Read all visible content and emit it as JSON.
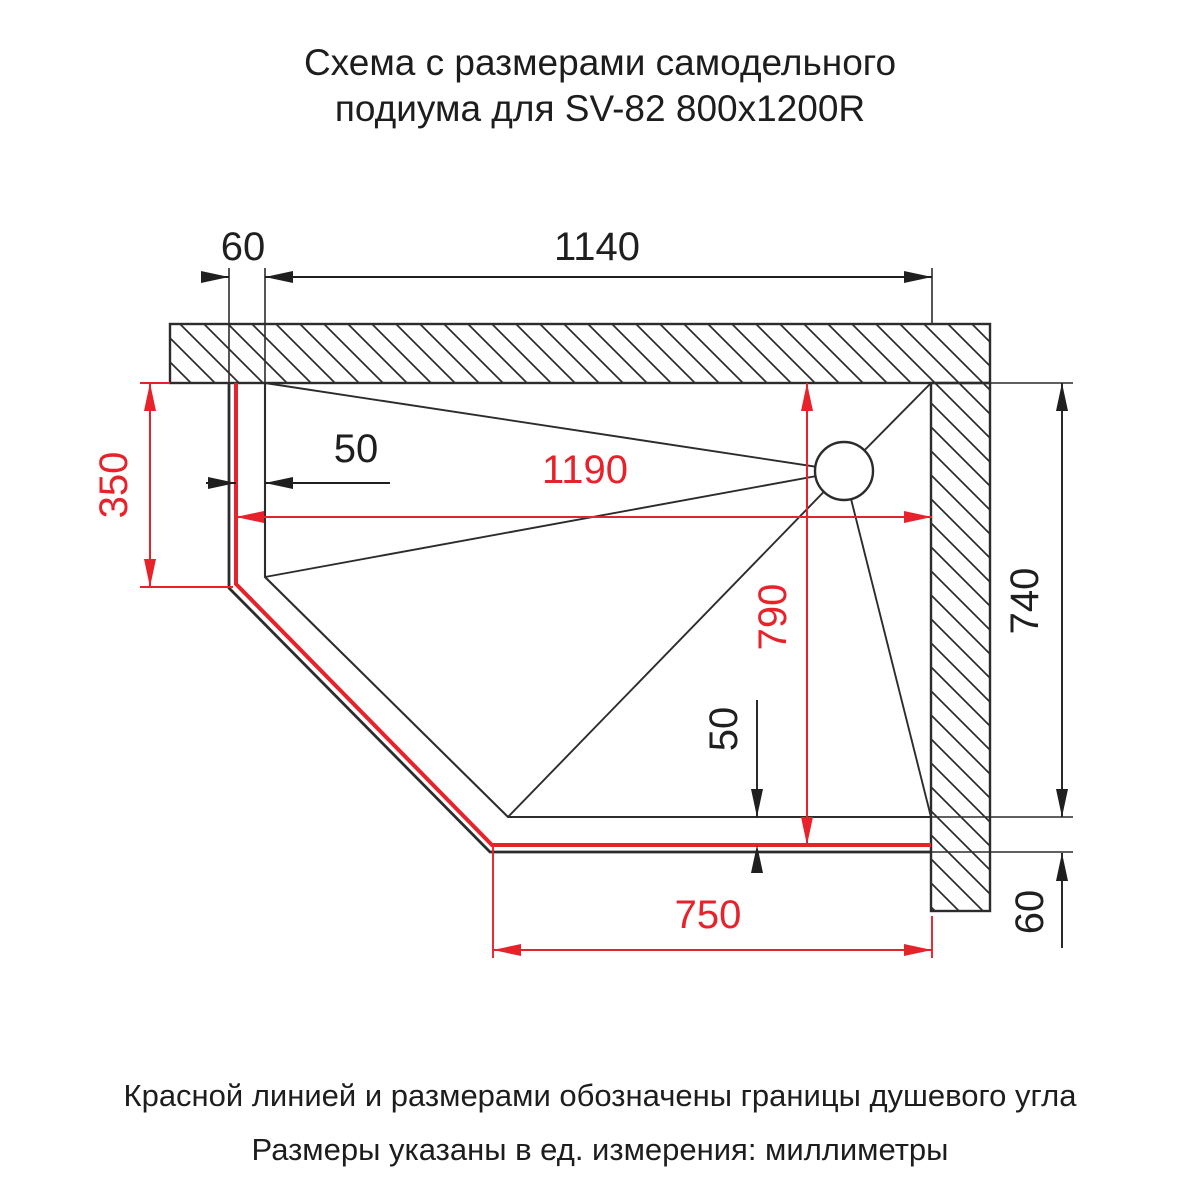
{
  "title": {
    "line1": "Схема с размерами самодельного",
    "line2": "подиума для SV-82 800x1200R"
  },
  "drawing": {
    "dims": {
      "podium_wall_gap": "60",
      "podium_top_width": "1140",
      "tray_inset_left": "50",
      "corner_left_depth": "350",
      "corner_width": "1190",
      "corner_depth": "790",
      "tray_inset_bottom": "50",
      "corner_bottom_width": "750",
      "wall_right_height": "740",
      "podium_bottom_gap": "60"
    },
    "colors": {
      "boundary_red": "#e8222a",
      "outline_black": "#2c2c2c"
    }
  },
  "footer": {
    "line1": "Красной линией и размерами обозначены границы душевого угла",
    "line2": "Размеры указаны в ед. измерения: миллиметры"
  }
}
